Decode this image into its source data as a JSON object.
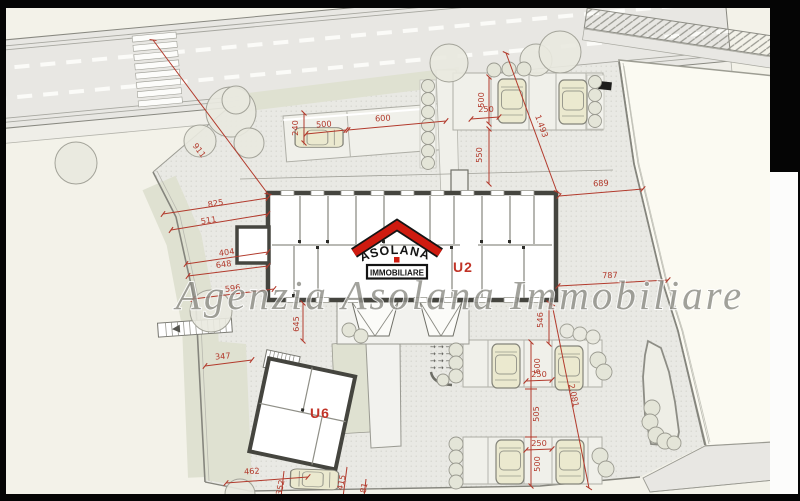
{
  "watermark": "Agenzia Asolana Immobiliare",
  "logo": {
    "name": "ASOLANA",
    "subtitle": "IMMOBILIARE",
    "roof_color": "#cf1b10"
  },
  "units": {
    "u2": "U2",
    "u6": "U6"
  },
  "dims": {
    "d911": "911",
    "d825": "825",
    "d511": "511",
    "d404": "404",
    "d648": "648",
    "d596": "596",
    "d645": "645",
    "d240": "240",
    "d500_top": "500",
    "d600": "600",
    "d250_tr": "250",
    "d500_tr": "500",
    "d550": "550",
    "d1493": "1.493",
    "d689": "689",
    "d787": "787",
    "d546": "546",
    "d2081": "2.081",
    "d500_br1": "500",
    "d250_br1": "250",
    "d505": "505",
    "d250_br2": "250",
    "d500_br2": "500",
    "d347": "347",
    "d462": "462",
    "d352": "352",
    "d415": "415",
    "d181": "181"
  },
  "decorations": {
    "ramp_arrows": "→→→→"
  },
  "colors": {
    "dimension_red": "#b23a2c",
    "logo_red": "#cf1b10",
    "paper": "#f3f2e9",
    "courtyard": "#e9e9e4",
    "green": "#dfe1d1",
    "watermark_gray": "#8e8e87",
    "frame_black": "#000000"
  }
}
